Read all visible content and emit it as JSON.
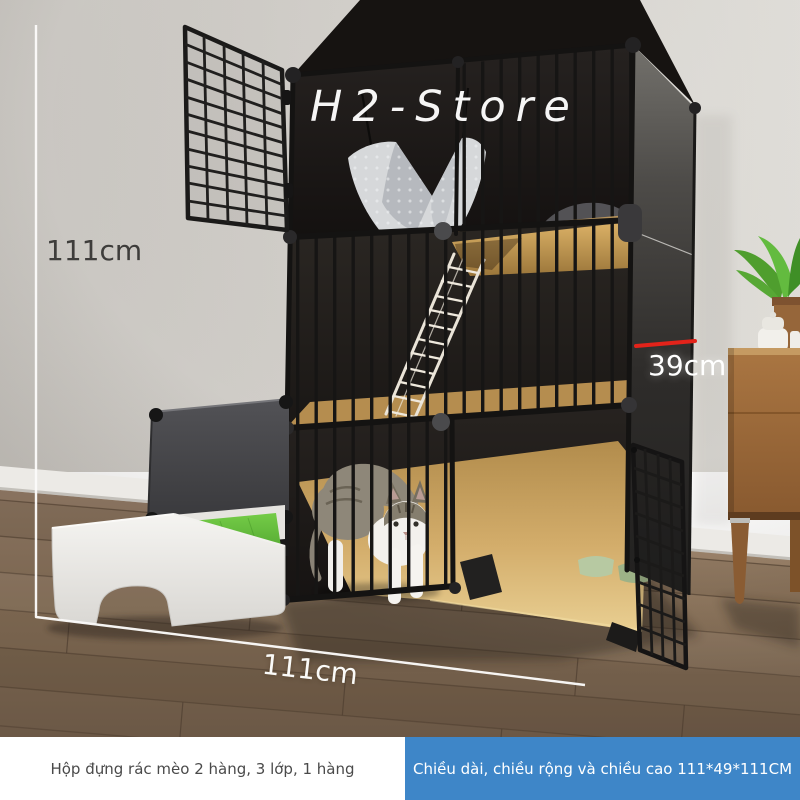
{
  "photo": {
    "watermark": "H2-Store",
    "labels": {
      "height": "111cm",
      "depth": "39cm",
      "width": "111cm"
    }
  },
  "captions": {
    "left": "Hộp đựng rác mèo 2 hàng, 3 lớp, 1 hàng",
    "right": "Chiều dài, chiều rộng và chiều cao 111*49*111CM"
  },
  "colors": {
    "caption_accent_blue": "#3e86c8",
    "dimension_line_red": "#e3231a",
    "dimension_line_white": "#fbfaf9",
    "caption_text_gray": "#4a4a4a"
  }
}
